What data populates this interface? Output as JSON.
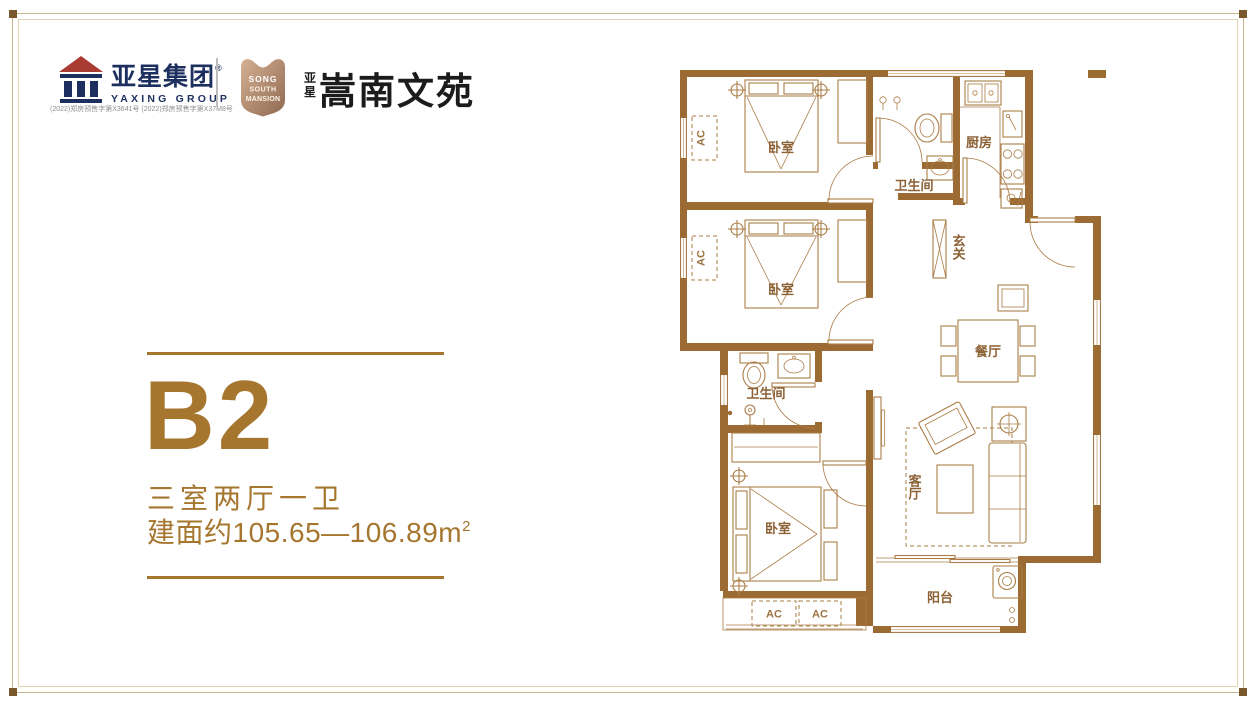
{
  "frame": {
    "border_color": "#c9b58f",
    "corner_color": "#7a572c"
  },
  "colors": {
    "wall": "#9c6b33",
    "accent": "#a6762f",
    "logo_navy": "#1c2f5e",
    "logo_red": "#a93b32"
  },
  "header": {
    "logo": {
      "company_cn": "亚星集团",
      "reg_mark": "®",
      "company_en": "YAXING GROUP",
      "permit_line": "(2022)郑房预售字第X3641号 (2022)郑房预售字第X37M8号"
    },
    "badge": {
      "line1": "SONG",
      "line2": "SOUTH",
      "line3": "MANSION"
    },
    "project": {
      "small_top": "亚",
      "small_bottom": "星",
      "name": "嵩南文苑"
    }
  },
  "info": {
    "unit": "B2",
    "rooms": "三室两厅一卫",
    "area": "建面约105.65—106.89m",
    "area_sup": "2"
  },
  "plan": {
    "bedroom": "卧室",
    "bathroom": "卫生间",
    "kitchen": "厨房",
    "hall": "玄关",
    "dining": "餐厅",
    "living": "客厅",
    "balcony": "阳台",
    "ac": "AC"
  }
}
